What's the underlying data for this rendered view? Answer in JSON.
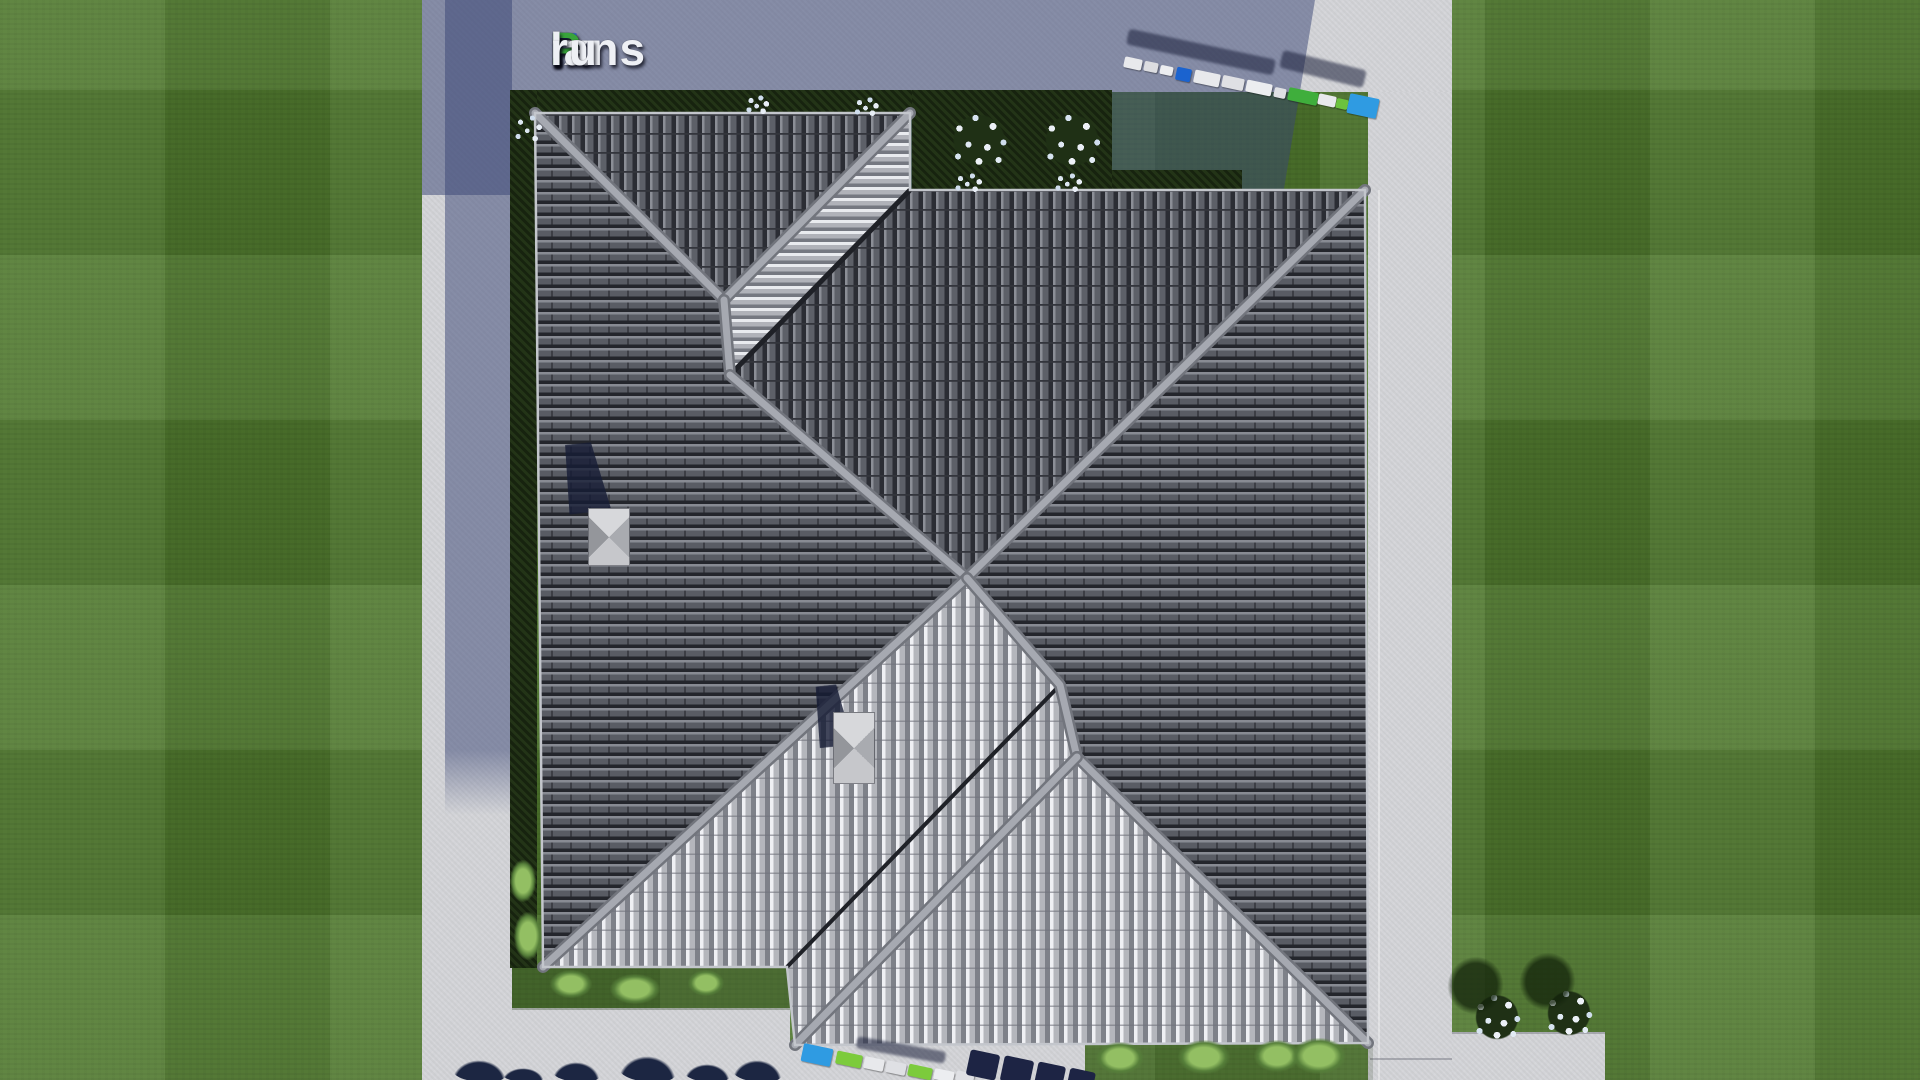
{
  "watermark": {
    "text": "FixPlans.ru",
    "parts": [
      {
        "t": "F",
        "c": "#2e62d6"
      },
      {
        "t": "ix",
        "c": "#eef0f5"
      },
      {
        "t": "P",
        "c": "#38a43b"
      },
      {
        "t": "lans",
        "c": "#eef0f5"
      },
      {
        "t": ".",
        "c": "#38a43b"
      },
      {
        "t": "ru",
        "c": "#eef0f5"
      }
    ]
  },
  "palette": {
    "lawn_green": "#50792e",
    "concrete": "#d3d4d8",
    "concrete_in_shadow": "#767d9b",
    "cast_shadow_blue": "#384474",
    "roof_tile_dark": "#595c64",
    "roof_tile_gap": "#24262c",
    "roof_tile_bright": "#eff0f4",
    "ridge_cap": "#a6a9b1",
    "hedge_dark_green": "#17230f",
    "marker_blue": "#2f9be2",
    "marker_deep_blue": "#1b63cf",
    "marker_green": "#7ccb3c",
    "marker_white": "#e8e9ec",
    "flower_white": "#e9eef5",
    "shrub_light_green": "#93bf63",
    "tree_shadow_navy": "#1c2642"
  },
  "roof": {
    "outline": "535,113 910,113 910,190 1365,190 1368,1043 795,1045 787,967 543,967",
    "slopes": [
      {
        "name": "left-wing-west",
        "pattern": "dark-rows",
        "points": "535,113 724,300 730,375 967,578 543,967"
      },
      {
        "name": "left-wing-north",
        "pattern": "dark-cols",
        "points": "535,113 910,113 724,300"
      },
      {
        "name": "left-wing-northeast",
        "pattern": "bright-rows",
        "points": "910,113 910,190 730,375 724,300"
      },
      {
        "name": "main-wing-north",
        "pattern": "dark-cols",
        "points": "910,190 1365,190 967,578 730,375"
      },
      {
        "name": "main-wing-east",
        "pattern": "dark-rows",
        "points": "1365,190 1368,1043 1077,757 1060,685 967,578"
      },
      {
        "name": "main-wing-southwest",
        "pattern": "dark-rows",
        "points": "967,578 1060,685 1077,757 1002,744"
      },
      {
        "name": "left-wing-southeast",
        "pattern": "bright-cols",
        "points": "543,967 967,578 1060,685 1077,757 795,1045 787,967"
      },
      {
        "name": "main-wing-south",
        "pattern": "bright-cols",
        "points": "1077,757 1368,1043 795,1045"
      }
    ],
    "valleys": [
      {
        "points": "910,190 730,375",
        "w": 5
      },
      {
        "points": "787,967 1060,685",
        "w": 4
      }
    ],
    "ridges": [
      {
        "points": "535,113 724,300"
      },
      {
        "points": "910,113 724,300"
      },
      {
        "points": "724,300 730,375"
      },
      {
        "points": "730,375 967,578"
      },
      {
        "points": "967,578 1365,190"
      },
      {
        "points": "967,578 543,967"
      },
      {
        "points": "967,578 1060,685 1077,757"
      },
      {
        "points": "1077,757 1368,1043"
      },
      {
        "points": "1077,757 795,1045"
      }
    ]
  },
  "vents": [
    {
      "x": 588,
      "y": 508,
      "w": 42,
      "h": 58,
      "shadow": {
        "x": 560,
        "y": 443,
        "w": 48,
        "h": 70
      }
    },
    {
      "x": 833,
      "y": 712,
      "w": 42,
      "h": 72,
      "shadow": {
        "x": 812,
        "y": 685,
        "w": 38,
        "h": 62
      }
    }
  ],
  "markers": {
    "top": {
      "shadows": [
        {
          "x": 1126,
          "y": 44,
          "w": 150,
          "h": 16,
          "rot": 12
        },
        {
          "x": 1280,
          "y": 60,
          "w": 86,
          "h": 18,
          "rot": 14
        }
      ],
      "items": [
        {
          "x": 1124,
          "y": 58,
          "w": 18,
          "h": 11,
          "c": "#e8e9ec",
          "rot": 12
        },
        {
          "x": 1144,
          "y": 62,
          "w": 14,
          "h": 10,
          "c": "#dcdde1",
          "rot": 12
        },
        {
          "x": 1160,
          "y": 66,
          "w": 13,
          "h": 9,
          "c": "#ecedf0",
          "rot": 12
        },
        {
          "x": 1176,
          "y": 68,
          "w": 15,
          "h": 13,
          "c": "#1b63cf",
          "rot": 12
        },
        {
          "x": 1194,
          "y": 72,
          "w": 26,
          "h": 13,
          "c": "#e8e9ec",
          "rot": 12
        },
        {
          "x": 1222,
          "y": 77,
          "w": 22,
          "h": 12,
          "c": "#dfe0e4",
          "rot": 12
        },
        {
          "x": 1246,
          "y": 82,
          "w": 26,
          "h": 12,
          "c": "#ecedf0",
          "rot": 12
        },
        {
          "x": 1274,
          "y": 88,
          "w": 12,
          "h": 10,
          "c": "#dfe0e4",
          "rot": 12
        },
        {
          "x": 1288,
          "y": 90,
          "w": 30,
          "h": 13,
          "c": "#3fae3c",
          "rot": 12
        },
        {
          "x": 1318,
          "y": 95,
          "w": 18,
          "h": 11,
          "c": "#e8e9ec",
          "rot": 12
        },
        {
          "x": 1336,
          "y": 99,
          "w": 12,
          "h": 10,
          "c": "#6cc23e",
          "rot": 12
        },
        {
          "x": 1348,
          "y": 96,
          "w": 30,
          "h": 20,
          "c": "#2f9be2",
          "rot": 12
        }
      ],
      "blobs": []
    },
    "bottom": {
      "shadows": [
        {
          "x": 856,
          "y": 1044,
          "w": 90,
          "h": 12,
          "rot": 10
        }
      ],
      "items": [
        {
          "x": 802,
          "y": 1046,
          "w": 30,
          "h": 18,
          "c": "#2f9be2",
          "rot": 12
        },
        {
          "x": 836,
          "y": 1053,
          "w": 26,
          "h": 13,
          "c": "#7ccb3c",
          "rot": 12
        },
        {
          "x": 864,
          "y": 1058,
          "w": 20,
          "h": 12,
          "c": "#e8e9ec",
          "rot": 12
        },
        {
          "x": 886,
          "y": 1062,
          "w": 20,
          "h": 12,
          "c": "#dfe0e4",
          "rot": 12
        },
        {
          "x": 908,
          "y": 1066,
          "w": 24,
          "h": 12,
          "c": "#7ccb3c",
          "rot": 12
        },
        {
          "x": 934,
          "y": 1070,
          "w": 20,
          "h": 11,
          "c": "#ecedf0",
          "rot": 12
        },
        {
          "x": 956,
          "y": 1072,
          "w": 18,
          "h": 10,
          "c": "#dfe0e4",
          "rot": 12
        }
      ],
      "blobs": [
        {
          "x": 968,
          "y": 1052,
          "w": 30,
          "h": 26,
          "rot": 12
        },
        {
          "x": 1002,
          "y": 1058,
          "w": 30,
          "h": 26,
          "rot": 12
        },
        {
          "x": 1036,
          "y": 1064,
          "w": 28,
          "h": 24,
          "rot": 12
        },
        {
          "x": 1068,
          "y": 1070,
          "w": 26,
          "h": 22,
          "rot": 12
        }
      ]
    }
  },
  "vegetation": [
    {
      "x": 944,
      "y": 104,
      "w": 70,
      "h": 70,
      "type": "flower-bush"
    },
    {
      "x": 1036,
      "y": 104,
      "w": 72,
      "h": 70,
      "type": "flower-bush"
    },
    {
      "x": 512,
      "y": 112,
      "w": 34,
      "h": 34,
      "type": "speckles"
    },
    {
      "x": 744,
      "y": 94,
      "w": 28,
      "h": 22,
      "type": "speckles"
    },
    {
      "x": 852,
      "y": 96,
      "w": 30,
      "h": 22,
      "type": "speckles"
    },
    {
      "x": 952,
      "y": 172,
      "w": 34,
      "h": 22,
      "type": "speckles"
    },
    {
      "x": 1052,
      "y": 172,
      "w": 34,
      "h": 22,
      "type": "speckles"
    },
    {
      "x": 1468,
      "y": 986,
      "w": 58,
      "h": 60,
      "type": "flower-bush-lawn"
    },
    {
      "x": 1540,
      "y": 982,
      "w": 58,
      "h": 60,
      "type": "flower-bush-lawn"
    },
    {
      "x": 550,
      "y": 970,
      "w": 42,
      "h": 28,
      "type": "bush-light"
    },
    {
      "x": 610,
      "y": 974,
      "w": 50,
      "h": 30,
      "type": "bush-light"
    },
    {
      "x": 688,
      "y": 970,
      "w": 36,
      "h": 26,
      "type": "bush-light"
    },
    {
      "x": 510,
      "y": 860,
      "w": 26,
      "h": 42,
      "type": "bush-light"
    },
    {
      "x": 514,
      "y": 912,
      "w": 28,
      "h": 48,
      "type": "bush-light"
    },
    {
      "x": 1096,
      "y": 1042,
      "w": 48,
      "h": 32,
      "type": "bush-light"
    },
    {
      "x": 1178,
      "y": 1040,
      "w": 52,
      "h": 34,
      "type": "bush-light"
    },
    {
      "x": 1254,
      "y": 1040,
      "w": 46,
      "h": 32,
      "type": "bush-light"
    },
    {
      "x": 1292,
      "y": 1038,
      "w": 54,
      "h": 36,
      "type": "bush-light"
    },
    {
      "x": 452,
      "y": 1060,
      "w": 54,
      "h": 22,
      "type": "tree-dark"
    },
    {
      "x": 502,
      "y": 1068,
      "w": 42,
      "h": 14,
      "type": "tree-dark"
    },
    {
      "x": 552,
      "y": 1062,
      "w": 48,
      "h": 20,
      "type": "tree-dark"
    },
    {
      "x": 618,
      "y": 1056,
      "w": 58,
      "h": 26,
      "type": "tree-dark"
    },
    {
      "x": 684,
      "y": 1064,
      "w": 46,
      "h": 18,
      "type": "tree-dark"
    },
    {
      "x": 732,
      "y": 1060,
      "w": 50,
      "h": 22,
      "type": "tree-dark"
    }
  ]
}
